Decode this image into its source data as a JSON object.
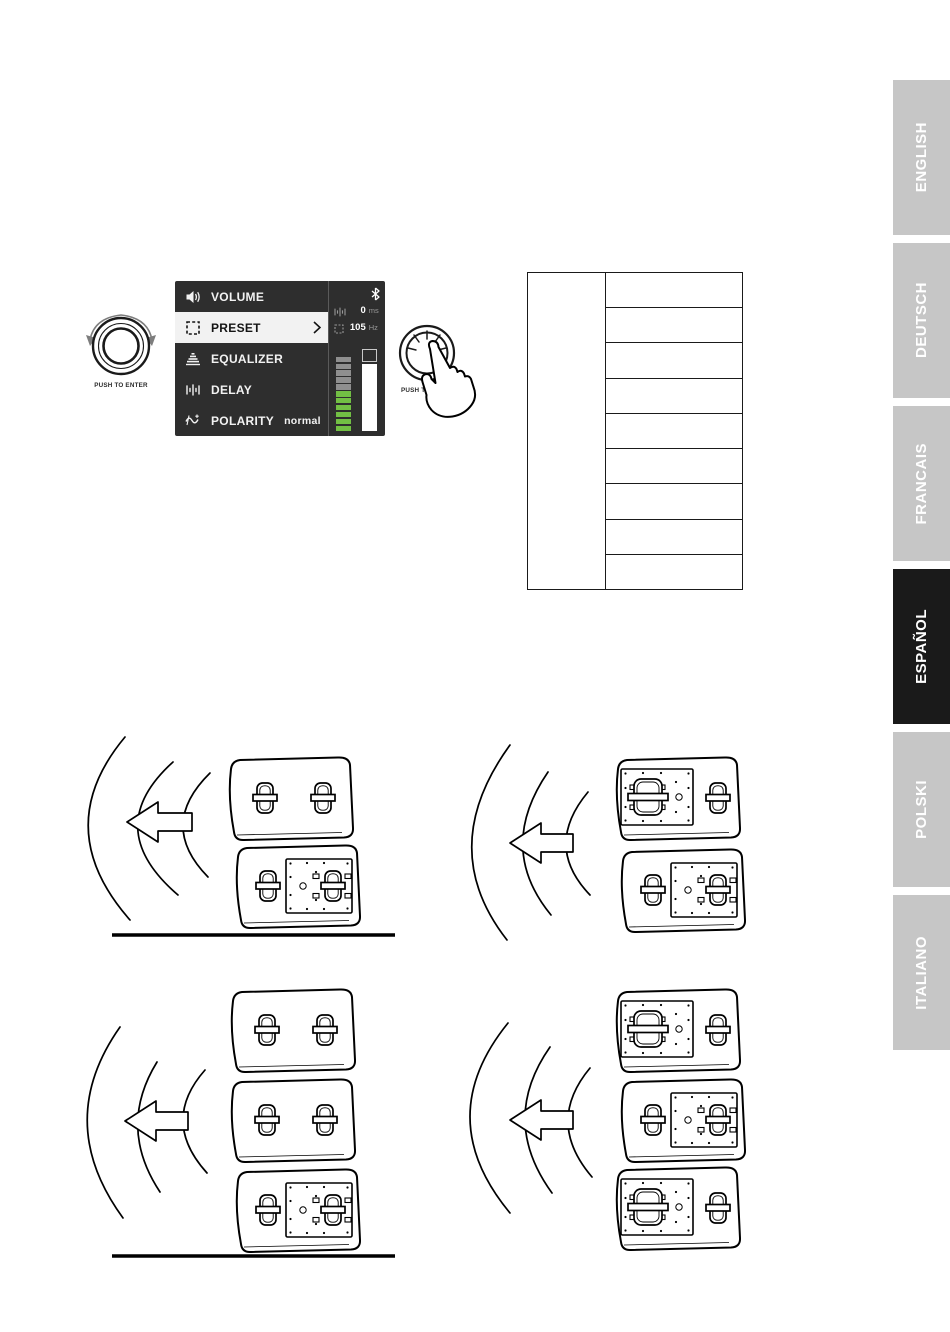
{
  "display_panel": {
    "menu_items": [
      {
        "label": "VOLUME",
        "icon": "volume-icon",
        "selected": false
      },
      {
        "label": "PRESET",
        "icon": "preset-icon",
        "selected": true
      },
      {
        "label": "EQUALIZER",
        "icon": "equalizer-icon",
        "selected": false
      },
      {
        "label": "DELAY",
        "icon": "delay-icon",
        "selected": false
      },
      {
        "label": "POLARITY",
        "icon": "polarity-icon",
        "selected": false,
        "value": "normal"
      }
    ],
    "status": {
      "bluetooth_icon": "bluetooth-icon",
      "delay": {
        "icon": "delay-small-icon",
        "value": "0",
        "unit": "ms"
      },
      "preset": {
        "icon": "preset-small-icon",
        "value": "105",
        "unit": "Hz"
      },
      "meter": {
        "gray_segments": 5,
        "green_segments": 6
      },
      "fader_position": "max"
    }
  },
  "rotary_knob": {
    "label": "PUSH TO ENTER"
  },
  "push_button": {
    "label": "PUSH TO ENTER"
  },
  "preset_table": {
    "columns": 2,
    "left_column_cells": 1,
    "right_column_rows": 9,
    "cells_empty": true
  },
  "language_tabs": [
    {
      "label": "ENGLISH",
      "active": false
    },
    {
      "label": "DEUTSCH",
      "active": false
    },
    {
      "label": "FRANCAIS",
      "active": false
    },
    {
      "label": "ESPAÑOL",
      "active": true
    },
    {
      "label": "POLSKI",
      "active": false
    },
    {
      "label": "ITALIANO",
      "active": false
    }
  ],
  "diagrams": [
    {
      "name": "stack-2-standard",
      "speakers": [
        "plain",
        "amp-right"
      ],
      "ground_line": true
    },
    {
      "name": "stack-2-cardioid",
      "speakers": [
        "amp-left",
        "amp-right"
      ],
      "ground_line": false
    },
    {
      "name": "stack-3-standard",
      "speakers": [
        "plain",
        "plain",
        "amp-right"
      ],
      "ground_line": true
    },
    {
      "name": "stack-3-cardioid",
      "speakers": [
        "amp-left",
        "amp-right",
        "amp-left"
      ],
      "ground_line": false
    }
  ],
  "colors": {
    "display_bg": "#2e2e2e",
    "selected_row_bg": "#f2f2f2",
    "meter_green": "#72bf44",
    "meter_gray": "#8f8f8f",
    "tab_gray": "#c6c6c6",
    "tab_active_bg": "#1a1a1a",
    "tab_text": "#ffffff"
  }
}
